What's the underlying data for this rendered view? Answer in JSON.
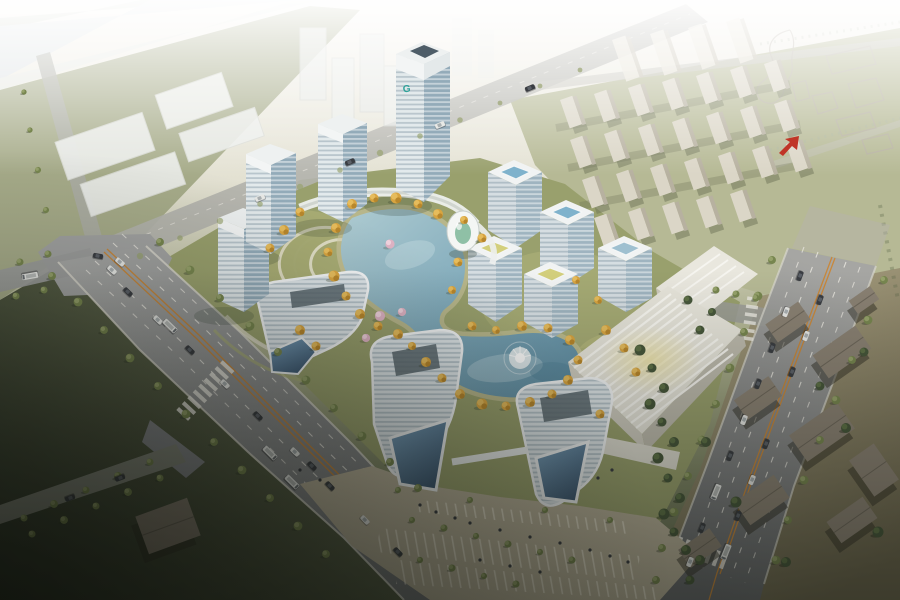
{
  "scene": {
    "label": "Aerial architectural rendering of a mixed-use development masterplan with an S-shaped central lake, striped glass towers, ring of mid-rise offices, exhibition hall, boulevards and surrounding fields",
    "tower_logo": "G"
  },
  "palette": {
    "haze": "#f6f4ee",
    "river": "#dde3e5",
    "bank": "#ccd2c5",
    "fieldLight": "#b6b998",
    "field": "#9aa07b",
    "fieldDark": "#79805f",
    "fieldDarkest": "#2c3326",
    "siteGreen": "#99a06d",
    "lawn": "#bdbd80",
    "path": "#cfc8a4",
    "road": "#9c9d9c",
    "roadLight": "#b3b3ac",
    "roadDark": "#6a6c6e",
    "curb": "#d9d7cd",
    "laneWhite": "#eceae2",
    "laneOrange": "#c8883c",
    "lakeLight": "#aecbd1",
    "lake": "#7fa9ba",
    "lakeDeep": "#5d8ba1",
    "autumn": "#d8a440",
    "autumnLight": "#e6bc5c",
    "autumnDark": "#b07f27",
    "blossom": "#dfb3c4",
    "treeGreen": "#77864f",
    "treeLight": "#96a26b",
    "treeDeep": "#46563a",
    "white": "#f1f3f3",
    "facade": "#dfe6e9",
    "glass": "#a8bdc9",
    "glassDark": "#8fa8b6",
    "glassDeep": "#54718a",
    "courtBlue": "#7fb2cc",
    "courtYellow": "#d3cf7c",
    "roofGlow": "#ecd98f",
    "hallRoof": "#e6e4da",
    "hallStripe": "#f8f7f2",
    "hallWall": "#c6c3b7",
    "resWall": "#dbd6c7",
    "resShade": "#b7b1a0",
    "resShadow": "#6e7458",
    "villageWall": "#8a8173",
    "villageShadow": "#2f2d24",
    "villageGround": "#a39a7a",
    "sketch": "#b5aea2",
    "arrowRed": "#c03527",
    "carDark": "#3a3d42",
    "carWhite": "#e8e9e6",
    "logoTeal": "#2fa39a"
  },
  "placements": {
    "autumn_trees": [
      [
        352,
        204,
        1
      ],
      [
        374,
        198,
        0.9
      ],
      [
        396,
        198,
        1.1
      ],
      [
        418,
        204,
        0.9
      ],
      [
        438,
        214,
        1
      ],
      [
        336,
        228,
        1
      ],
      [
        328,
        252,
        0.9
      ],
      [
        334,
        276,
        1.1
      ],
      [
        346,
        296,
        0.9
      ],
      [
        360,
        314,
        1
      ],
      [
        378,
        326,
        0.9
      ],
      [
        398,
        334,
        1
      ],
      [
        412,
        346,
        0.8
      ],
      [
        426,
        362,
        1
      ],
      [
        442,
        378,
        0.9
      ],
      [
        460,
        394,
        1
      ],
      [
        482,
        404,
        1.1
      ],
      [
        506,
        406,
        0.9
      ],
      [
        530,
        402,
        1
      ],
      [
        552,
        394,
        0.9
      ],
      [
        568,
        380,
        1
      ],
      [
        578,
        360,
        0.9
      ],
      [
        570,
        340,
        1
      ],
      [
        548,
        328,
        0.9
      ],
      [
        522,
        326,
        1
      ],
      [
        496,
        330,
        0.8
      ],
      [
        472,
        326,
        0.9
      ],
      [
        452,
        290,
        0.8
      ],
      [
        458,
        262,
        0.9
      ],
      [
        300,
        212,
        0.9
      ],
      [
        284,
        230,
        1
      ],
      [
        270,
        248,
        0.9
      ],
      [
        464,
        220,
        0.8
      ],
      [
        482,
        238,
        0.9
      ],
      [
        300,
        330,
        1
      ],
      [
        316,
        346,
        0.9
      ],
      [
        606,
        330,
        1
      ],
      [
        624,
        348,
        0.9
      ],
      [
        598,
        300,
        0.8
      ],
      [
        576,
        280,
        0.8
      ],
      [
        636,
        372,
        0.9
      ],
      [
        600,
        414,
        0.9
      ]
    ],
    "blossom_trees": [
      [
        390,
        244,
        1
      ],
      [
        380,
        316,
        1.1
      ],
      [
        402,
        312,
        0.9
      ],
      [
        366,
        338,
        0.9
      ]
    ],
    "green_trees": [
      [
        160,
        242,
        0.9
      ],
      [
        190,
        270,
        1
      ],
      [
        220,
        298,
        0.9
      ],
      [
        250,
        326,
        1
      ],
      [
        278,
        352,
        0.9
      ],
      [
        306,
        380,
        1
      ],
      [
        334,
        408,
        0.9
      ],
      [
        362,
        436,
        1
      ],
      [
        390,
        462,
        0.9
      ],
      [
        418,
        488,
        0.9
      ],
      [
        52,
        276,
        0.9
      ],
      [
        78,
        302,
        1
      ],
      [
        104,
        330,
        0.9
      ],
      [
        130,
        358,
        1
      ],
      [
        158,
        386,
        0.9
      ],
      [
        186,
        414,
        1
      ],
      [
        214,
        442,
        0.9
      ],
      [
        242,
        470,
        1
      ],
      [
        270,
        498,
        0.9
      ],
      [
        298,
        526,
        1
      ],
      [
        326,
        554,
        0.9
      ],
      [
        150,
        462,
        0.8
      ],
      [
        118,
        476,
        0.9
      ],
      [
        86,
        490,
        0.8
      ],
      [
        54,
        504,
        0.9
      ],
      [
        24,
        518,
        0.8
      ],
      [
        160,
        478,
        0.8
      ],
      [
        128,
        492,
        0.9
      ],
      [
        96,
        506,
        0.8
      ],
      [
        64,
        520,
        0.9
      ],
      [
        32,
        534,
        0.8
      ],
      [
        20,
        262,
        0.8
      ],
      [
        48,
        254,
        0.8
      ],
      [
        16,
        296,
        0.8
      ],
      [
        44,
        290,
        0.8
      ],
      [
        46,
        210,
        0.7
      ],
      [
        38,
        170,
        0.7
      ],
      [
        30,
        130,
        0.6
      ],
      [
        24,
        92,
        0.6
      ],
      [
        772,
        260,
        0.9
      ],
      [
        758,
        296,
        1
      ],
      [
        744,
        332,
        0.9
      ],
      [
        730,
        368,
        1
      ],
      [
        716,
        404,
        0.9
      ],
      [
        702,
        440,
        1
      ],
      [
        688,
        476,
        0.9
      ],
      [
        674,
        512,
        1
      ],
      [
        662,
        548,
        0.9
      ],
      [
        656,
        580,
        0.9
      ],
      [
        884,
        280,
        0.9
      ],
      [
        868,
        320,
        1
      ],
      [
        852,
        360,
        0.9
      ],
      [
        836,
        400,
        1
      ],
      [
        820,
        440,
        0.9
      ],
      [
        804,
        480,
        1
      ],
      [
        788,
        520,
        0.9
      ],
      [
        776,
        560,
        1
      ],
      [
        716,
        290,
        0.8
      ],
      [
        736,
        294,
        0.8
      ],
      [
        756,
        298,
        0.8
      ],
      [
        412,
        520,
        0.7
      ],
      [
        444,
        528,
        0.8
      ],
      [
        476,
        536,
        0.7
      ],
      [
        508,
        544,
        0.8
      ],
      [
        540,
        552,
        0.7
      ],
      [
        572,
        560,
        0.8
      ],
      [
        420,
        560,
        0.7
      ],
      [
        452,
        568,
        0.8
      ],
      [
        484,
        576,
        0.7
      ],
      [
        516,
        584,
        0.8
      ],
      [
        398,
        490,
        0.7
      ],
      [
        470,
        500,
        0.7
      ],
      [
        545,
        510,
        0.7
      ],
      [
        610,
        520,
        0.7
      ]
    ],
    "faint_trees": [
      [
        140,
        256,
        0.8
      ],
      [
        180,
        238,
        0.7
      ],
      [
        220,
        221,
        0.8
      ],
      [
        260,
        204,
        0.7
      ],
      [
        300,
        187,
        0.8
      ],
      [
        340,
        170,
        0.7
      ],
      [
        380,
        153,
        0.8
      ],
      [
        420,
        136,
        0.7
      ],
      [
        460,
        120,
        0.7
      ],
      [
        500,
        103,
        0.6
      ],
      [
        540,
        86,
        0.6
      ],
      [
        580,
        70,
        0.6
      ]
    ],
    "dark_trees": [
      [
        640,
        350,
        1.1
      ],
      [
        652,
        368,
        0.9
      ],
      [
        664,
        388,
        1
      ],
      [
        650,
        404,
        1.1
      ],
      [
        662,
        422,
        0.9
      ],
      [
        674,
        442,
        1
      ],
      [
        658,
        458,
        1.1
      ],
      [
        668,
        478,
        0.9
      ],
      [
        680,
        498,
        1
      ],
      [
        664,
        514,
        1.1
      ],
      [
        674,
        532,
        0.9
      ],
      [
        686,
        550,
        1
      ],
      [
        700,
        330,
        0.9
      ],
      [
        712,
        312,
        0.8
      ],
      [
        688,
        300,
        0.9
      ],
      [
        700,
        560,
        1
      ],
      [
        690,
        580,
        0.9
      ],
      [
        706,
        442,
        1
      ],
      [
        736,
        502,
        1.1
      ],
      [
        786,
        562,
        1
      ],
      [
        846,
        428,
        1
      ],
      [
        878,
        532,
        1.1
      ],
      [
        820,
        386,
        0.9
      ],
      [
        864,
        352,
        0.9
      ]
    ],
    "cars": [
      [
        128,
        292,
        44,
        "car-dark"
      ],
      [
        158,
        320,
        44,
        "car-white"
      ],
      [
        190,
        350,
        44,
        "car-dark"
      ],
      [
        225,
        384,
        45,
        "car-white"
      ],
      [
        258,
        416,
        45,
        "car-dark"
      ],
      [
        295,
        452,
        45,
        "car-white"
      ],
      [
        330,
        486,
        46,
        "car-dark"
      ],
      [
        365,
        520,
        46,
        "car-white"
      ],
      [
        398,
        552,
        46,
        "car-dark"
      ],
      [
        112,
        270,
        43,
        "car-white"
      ],
      [
        270,
        453,
        45,
        "bus"
      ],
      [
        292,
        482,
        45,
        "bus"
      ],
      [
        170,
        326,
        44,
        "bus"
      ],
      [
        312,
        466,
        45,
        "car-dark"
      ],
      [
        260,
        198,
        -22,
        "car-white"
      ],
      [
        350,
        162,
        -22,
        "car-dark"
      ],
      [
        440,
        125,
        -22,
        "car-white"
      ],
      [
        530,
        88,
        -22,
        "car-dark"
      ],
      [
        800,
        276,
        110,
        "car-dark"
      ],
      [
        786,
        312,
        110,
        "car-white"
      ],
      [
        772,
        348,
        110,
        "car-dark"
      ],
      [
        758,
        384,
        111,
        "car-dark"
      ],
      [
        744,
        420,
        111,
        "car-white"
      ],
      [
        730,
        456,
        111,
        "car-dark"
      ],
      [
        716,
        492,
        112,
        "bus"
      ],
      [
        702,
        528,
        112,
        "car-dark"
      ],
      [
        690,
        562,
        112,
        "car-white"
      ],
      [
        820,
        300,
        110,
        "car-dark"
      ],
      [
        806,
        336,
        110,
        "car-white"
      ],
      [
        792,
        372,
        111,
        "car-dark"
      ],
      [
        766,
        444,
        111,
        "car-dark"
      ],
      [
        752,
        480,
        112,
        "car-white"
      ],
      [
        738,
        516,
        112,
        "car-dark"
      ],
      [
        726,
        552,
        112,
        "bus"
      ],
      [
        120,
        478,
        160,
        "car-dark"
      ],
      [
        70,
        498,
        160,
        "car-dark"
      ],
      [
        30,
        276,
        170,
        "bus"
      ],
      [
        120,
        262,
        40,
        "car-white"
      ],
      [
        98,
        256,
        10,
        "car-dark"
      ]
    ],
    "people": [
      [
        420,
        505
      ],
      [
        436,
        512
      ],
      [
        455,
        518
      ],
      [
        470,
        523
      ],
      [
        500,
        530
      ],
      [
        530,
        537
      ],
      [
        560,
        543
      ],
      [
        590,
        550
      ],
      [
        610,
        556
      ],
      [
        628,
        562
      ],
      [
        480,
        560
      ],
      [
        510,
        566
      ],
      [
        540,
        572
      ],
      [
        300,
        470
      ],
      [
        320,
        480
      ],
      [
        598,
        478
      ],
      [
        612,
        470
      ]
    ],
    "res_blocks": [
      [
        560,
        100
      ],
      [
        594,
        94
      ],
      [
        628,
        88
      ],
      [
        662,
        82
      ],
      [
        696,
        76
      ],
      [
        730,
        70
      ],
      [
        764,
        64
      ],
      [
        570,
        140
      ],
      [
        604,
        134
      ],
      [
        638,
        128
      ],
      [
        672,
        122
      ],
      [
        706,
        116
      ],
      [
        740,
        110
      ],
      [
        774,
        104
      ],
      [
        582,
        180
      ],
      [
        616,
        174
      ],
      [
        650,
        168
      ],
      [
        684,
        162
      ],
      [
        718,
        156
      ],
      [
        752,
        150
      ],
      [
        786,
        144
      ],
      [
        594,
        218
      ],
      [
        628,
        212
      ],
      [
        662,
        206
      ],
      [
        696,
        200
      ],
      [
        730,
        194
      ]
    ],
    "res_slabs": [
      [
        612,
        40
      ],
      [
        650,
        34
      ],
      [
        688,
        28
      ],
      [
        726,
        22
      ]
    ],
    "village_houses": [
      [
        788,
        322,
        40,
        22,
        -35
      ],
      [
        842,
        352,
        52,
        28,
        -35
      ],
      [
        758,
        398,
        42,
        24,
        -35
      ],
      [
        822,
        432,
        58,
        32,
        -35
      ],
      [
        762,
        500,
        48,
        28,
        -35
      ],
      [
        852,
        520,
        44,
        26,
        -35
      ],
      [
        700,
        548,
        38,
        22,
        -35
      ],
      [
        874,
        470,
        30,
        44,
        -35
      ],
      [
        864,
        300,
        26,
        16,
        -35
      ],
      [
        168,
        526,
        55,
        40,
        -20
      ]
    ]
  }
}
